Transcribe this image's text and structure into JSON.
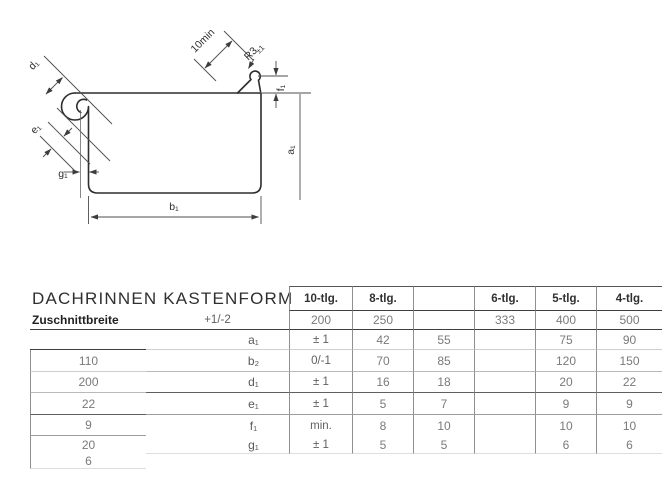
{
  "diagram": {
    "labels": {
      "bead_diameter": "d₁",
      "bead_edge_distance": "e₁",
      "drip_gap": "g₁",
      "bottom_width": "b₁",
      "depth": "a₁",
      "front_edge_height": "f₁",
      "radius": "R3",
      "radius_tolerance": "±1",
      "flap_min_length": "10min"
    }
  },
  "table": {
    "title": "DACHRINNEN KASTENFORM",
    "columns": [
      "10-tlg.",
      "8-tlg.",
      "",
      "6-tlg.",
      "5-tlg.",
      "4-tlg."
    ],
    "cut_width": {
      "label": "Zuschnittbreite",
      "tolerance": "+1/-2",
      "values": [
        "200",
        "250",
        "",
        "333",
        "400",
        "500"
      ]
    },
    "rows": [
      {
        "symbol": "a₁",
        "tolerance": "± 1",
        "values": [
          "42",
          "55",
          "",
          "75",
          "90",
          "110"
        ]
      },
      {
        "symbol": "b₂",
        "tolerance": "0/-1",
        "values": [
          "70",
          "85",
          "",
          "120",
          "150",
          "200"
        ]
      },
      {
        "symbol": "d₁",
        "tolerance": "± 1",
        "values": [
          "16",
          "18",
          "",
          "20",
          "22",
          "22"
        ]
      },
      {
        "symbol": "e₁",
        "tolerance": "± 1",
        "values": [
          "5",
          "7",
          "",
          "9",
          "9",
          "9"
        ]
      },
      {
        "symbol": "f₁",
        "tolerance": "min.",
        "values": [
          "8",
          "10",
          "",
          "10",
          "10",
          "20"
        ]
      },
      {
        "symbol": "g₁",
        "tolerance": "± 1",
        "values": [
          "5",
          "5",
          "",
          "6",
          "6",
          "6"
        ]
      }
    ]
  }
}
